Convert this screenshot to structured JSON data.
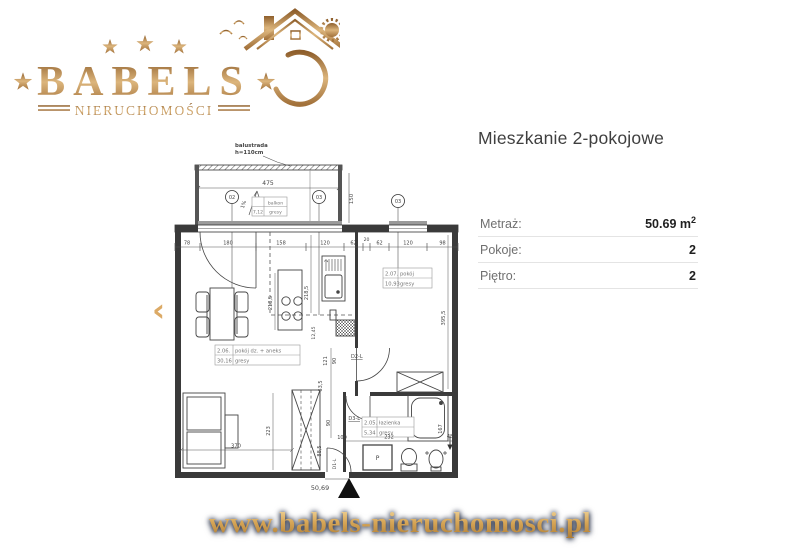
{
  "colors": {
    "gold": "#c08a4a",
    "gold_light": "#e9c98c",
    "gold_dark": "#8d5f2a",
    "text_dark": "#3f3f3f",
    "divider": "#e4e4e4",
    "plan_ink": "#3a3a3a",
    "footer_glow": "#1c2940"
  },
  "logo": {
    "brand": "BABELS",
    "subtitle": "NIERUCHOMOŚCI"
  },
  "carousel": {
    "prev": "‹"
  },
  "listing": {
    "title": "Mieszkanie 2-pokojowe",
    "rows": [
      {
        "label": "Metraż:",
        "value": "50.69 m",
        "sup": "2"
      },
      {
        "label": "Pokoje:",
        "value": "2"
      },
      {
        "label": "Piętro:",
        "value": "2"
      }
    ]
  },
  "footer": {
    "url": "www.babels-nieruchomosci.pl"
  },
  "plan": {
    "balustrade_line1": "balustrada",
    "balustrade_line2": "h=110cm",
    "balcony_width": "475",
    "balcony_depth": "150",
    "slope": "1%",
    "balcony_name": "balkon",
    "balcony_area": "7,12",
    "balcony_floor": "gresy",
    "marker_1": "02",
    "marker_2": "03",
    "marker_3": "03",
    "dims_top": [
      "78",
      "180",
      "158",
      "120",
      "62",
      "20",
      "62",
      "120",
      "98"
    ],
    "room_living_no": "2.06.",
    "room_living_name": "pokój dz. + aneks",
    "room_living_area": "30,16",
    "room_living_floor": "gresy",
    "room_bedroom_no": "2.07.",
    "room_bedroom_name": "pokój",
    "room_bedroom_area": "10,93",
    "room_bedroom_floor": "gresy",
    "room_bath_no": "2.05.",
    "room_bath_name": "łazienka",
    "room_bath_area": "5,34",
    "room_bath_floor": "gresy",
    "door_1": "D1-L",
    "door_2": "D2-L",
    "door_3": "D3-L",
    "dim_kitchen_a": "218,5",
    "dim_kitchen_b": "218,5",
    "dim_kitchen_c": "12,45",
    "dim_sink": "2",
    "dim_hall_121": "121",
    "dim_hall_90a": "90",
    "dim_hall_635": "63,5",
    "dim_hall_90b": "90",
    "dim_hall_885": "88,5",
    "dim_hall_100": "100",
    "dim_living_w": "370",
    "dim_living_h": "223",
    "dim_bedroom_h": "395,5",
    "dim_bath_w": "232",
    "dim_bath_h": "167",
    "dim_bath_c": "48",
    "washer": "P",
    "total_area": "50,69"
  }
}
